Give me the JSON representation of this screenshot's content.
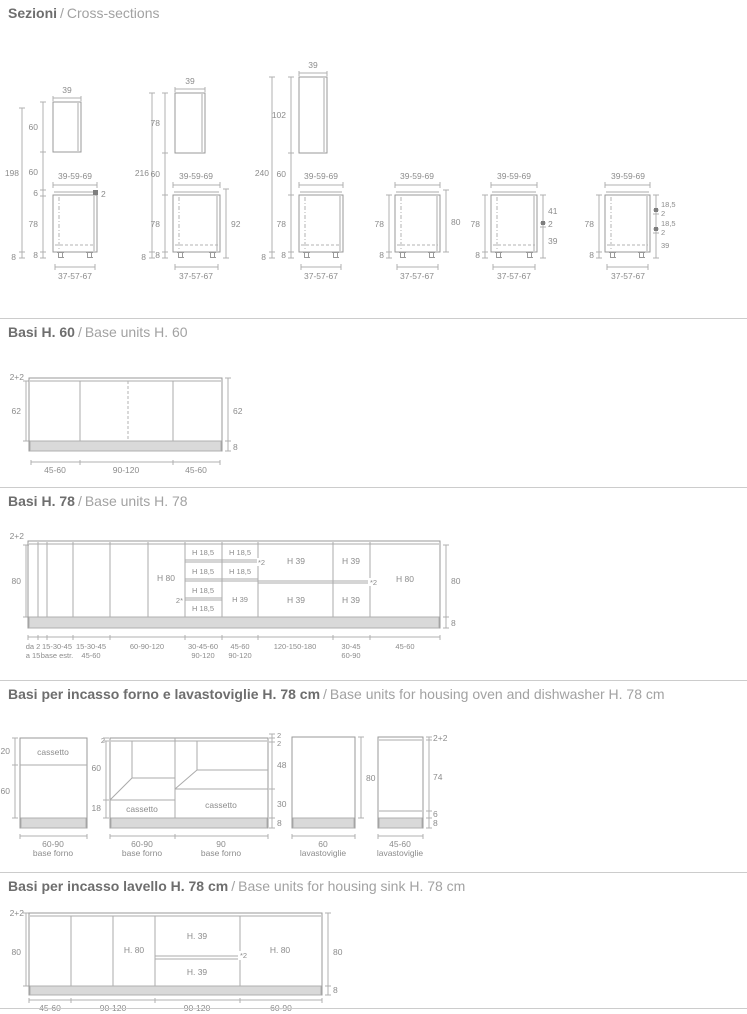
{
  "colors": {
    "line": "#999999",
    "dim": "#b0b0b0",
    "text": "#8c8c8c",
    "plinth": "#d9d9d9",
    "rule": "#cccccc",
    "title_it": "#6e6e6e",
    "title_en": "#a2a2a2"
  },
  "titles": {
    "s1": {
      "it": "Sezioni",
      "sep": "/",
      "en": "Cross-sections"
    },
    "s2": {
      "it": "Basi H. 60",
      "sep": "/",
      "en": "Base units H. 60"
    },
    "s3": {
      "it": "Basi H. 78",
      "sep": "/",
      "en": "Base units H. 78"
    },
    "s4": {
      "it": "Basi per incasso forno e lavastoviglie H. 78 cm",
      "sep": "/",
      "en": "Base units for housing oven and dishwasher H. 78 cm"
    },
    "s5": {
      "it": "Basi per incasso lavello H. 78 cm",
      "sep": "/",
      "en": "Base units for housing sink H. 78 cm"
    }
  },
  "cross": {
    "d1": {
      "total": "198",
      "total_foot": "8",
      "wall_w": "39",
      "col": [
        "60",
        "60",
        "6",
        "78",
        "8"
      ],
      "worktop": "2",
      "base_top": "39-59-69",
      "base_bottom": "37-57-67"
    },
    "d2": {
      "total": "216",
      "total_foot": "8",
      "wall_w": "39",
      "col": [
        "78",
        "60",
        "78",
        "8"
      ],
      "right": "92",
      "base_top": "39-59-69",
      "base_bottom": "37-57-67"
    },
    "d3": {
      "total": "240",
      "total_foot": "8",
      "wall_w": "39",
      "col": [
        "102",
        "60",
        "78",
        "8"
      ],
      "base_top": "39-59-69",
      "base_bottom": "37-57-67"
    },
    "d4": {
      "left": [
        "78",
        "8"
      ],
      "right": [
        "80"
      ],
      "base_top": "39-59-69",
      "base_bottom": "37-57-67"
    },
    "d5": {
      "left": [
        "78",
        "8"
      ],
      "right": [
        "41",
        "2",
        "39"
      ],
      "base_top": "39-59-69",
      "base_bottom": "37-57-67"
    },
    "d6": {
      "left": [
        "78",
        "8"
      ],
      "right": [
        "18,5",
        "2",
        "18,5",
        "2",
        "39"
      ],
      "base_top": "39-59-69",
      "base_bottom": "37-57-67"
    }
  },
  "h60": {
    "top_left": "2+2",
    "left": "62",
    "right": "62",
    "plinth": "8",
    "widths": [
      "45-60",
      "90-120",
      "45-60"
    ]
  },
  "h78": {
    "top_left": "2+2",
    "left": "80",
    "right": "80",
    "plinth": "8",
    "c4_label": "H 80",
    "c5_rows": [
      "H 18,5",
      "H 18,5",
      "H 18,5",
      "H 18,5"
    ],
    "c5_marker": "2*",
    "c6_rows": [
      "H 18,5",
      "H 18,5",
      "H 39"
    ],
    "c6_marker": "*2",
    "c7_rows": [
      "H 39",
      "H 39"
    ],
    "c8_rows": [
      "H 39",
      "H 39"
    ],
    "c9_label": "H 80",
    "c9_marker": "*2",
    "widths": [
      [
        "da 2",
        "a 15"
      ],
      [
        "15-30-45",
        "base estr."
      ],
      [
        "15-30-45",
        "45-60"
      ],
      [
        "60-90-120",
        ""
      ],
      [
        "30-45-60",
        "90-120"
      ],
      [
        "45-60",
        "90-120"
      ],
      [
        "120-150-180",
        ""
      ],
      [
        "30-45",
        "60-90"
      ],
      [
        "45-60",
        ""
      ]
    ]
  },
  "oven": {
    "a": {
      "left": [
        "20",
        "60"
      ],
      "cell": "cassetto",
      "width": "60-90",
      "caption": "base forno"
    },
    "b": {
      "left": [
        "2",
        "60",
        "18"
      ],
      "right": [
        "2",
        "2",
        "48",
        "30",
        "8"
      ],
      "drawer1": "cassetto",
      "drawer2": "cassetto",
      "bays": [
        {
          "width": "60-90",
          "caption": "base forno"
        },
        {
          "width": "90",
          "caption": "base forno"
        }
      ]
    },
    "c": {
      "right": [
        "80"
      ],
      "width": "60",
      "caption": "lavastoviglie"
    },
    "d": {
      "right": [
        "2+2",
        "74",
        "6",
        "8"
      ],
      "width": "45-60",
      "caption": "lavastoviglie"
    }
  },
  "sink": {
    "top_left": "2+2",
    "left": "80",
    "right": "80",
    "plinth": "8",
    "c2_label": "H. 80",
    "c3_rows": [
      "H. 39",
      "H. 39"
    ],
    "c3_marker": "*2",
    "c4_label": "H. 80",
    "widths": [
      "45-60",
      "90-120",
      "90-120",
      "60-90"
    ]
  }
}
